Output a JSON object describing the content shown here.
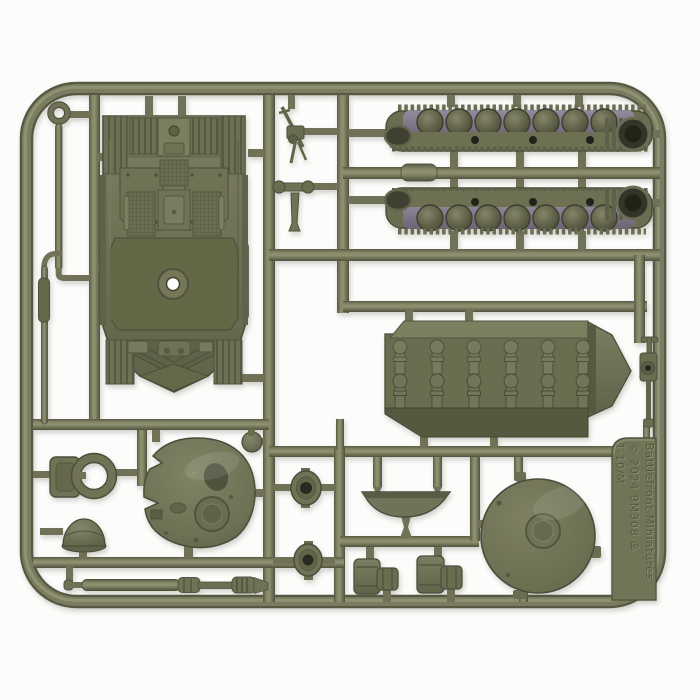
{
  "sprue": {
    "embossed_text": {
      "maker": "Battlefront Miniatures",
      "copyright_code": "© 2024   BM308 ♸",
      "model": "T-10/M"
    },
    "palette": {
      "background": "#fcfcfb",
      "plastic_light": "#8f9172",
      "plastic_mid": "#71735a",
      "plastic_dark": "#565843",
      "plastic_deep": "#3f4130",
      "track_gap_purple": "#867d92",
      "hole_black": "#23241b"
    },
    "parts": [
      "upper-hull-top",
      "left-track",
      "right-track",
      "lower-hull",
      "turret-roof",
      "turret-base",
      "gun-barrel",
      "tow-cable-a",
      "tow-cable-b",
      "commander-cupola",
      "hatch-ring",
      "rect-hatch",
      "aa-machine-gun",
      "aa-machine-gun-2",
      "gun-cradle",
      "fuel-drums-1",
      "fuel-drums-2",
      "turret-bottom-tub",
      "round-hatch-1",
      "round-hatch-2",
      "ball-mount"
    ]
  }
}
